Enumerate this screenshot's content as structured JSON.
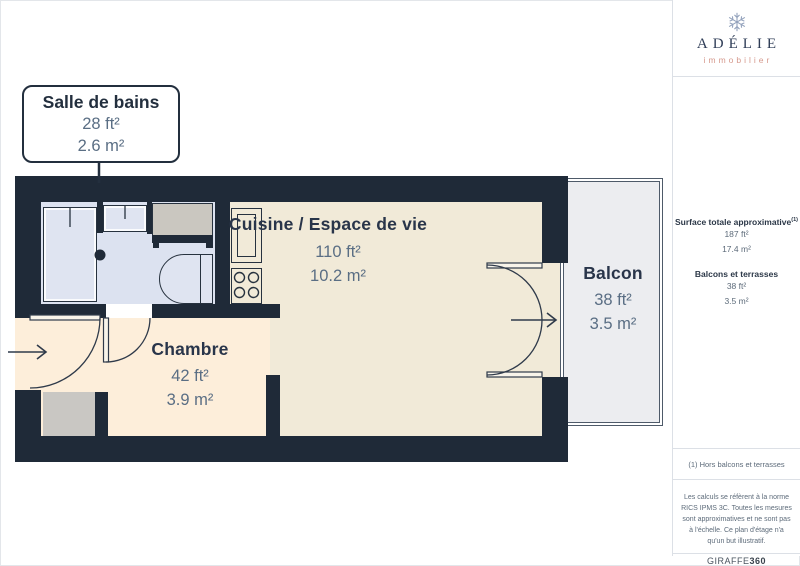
{
  "colors": {
    "wall": "#1f2a38",
    "bathroom_floor": "#dce2f0",
    "living_floor": "#f1ead8",
    "bedroom_floor": "#fdeeda",
    "closet_floor": "#c9c7c3",
    "balcony_floor": "#ecedf0",
    "room_name_text": "#29354a",
    "room_value_text": "#5a6e84",
    "logo_navy": "#2f3d57",
    "logo_salmon": "#d6998d"
  },
  "logo": {
    "brand": "ADÉLIE",
    "tagline": "immobilier"
  },
  "sidebar": {
    "surface_label": "Surface totale approximative",
    "surface_sup": "(1)",
    "surface_ft": "187 ft²",
    "surface_m": "17.4 m²",
    "terrace_label": "Balcons et terrasses",
    "terrace_ft": "38 ft²",
    "terrace_m": "3.5 m²",
    "footnote": "(1) Hors balcons et terrasses",
    "disclaimer": "Les calculs se réfèrent à la norme RICS IPMS 3C. Toutes les mesures sont approximatives et ne sont pas à l'échelle. Ce plan d'étage n'a qu'un but illustratif.",
    "brand_mark": "GIRAFFE",
    "brand_mark_bold": "360"
  },
  "plan": {
    "bathroom": {
      "name": "Salle de bains",
      "area_ft": "28 ft²",
      "area_m": "2.6 m²"
    },
    "kitchen": {
      "name": "Cuisine / Espace de vie",
      "area_ft": "110 ft²",
      "area_m": "10.2 m²"
    },
    "bedroom": {
      "name": "Chambre",
      "area_ft": "42 ft²",
      "area_m": "3.9 m²"
    },
    "balcony": {
      "name": "Balcon",
      "area_ft": "38 ft²",
      "area_m": "3.5 m²"
    }
  }
}
